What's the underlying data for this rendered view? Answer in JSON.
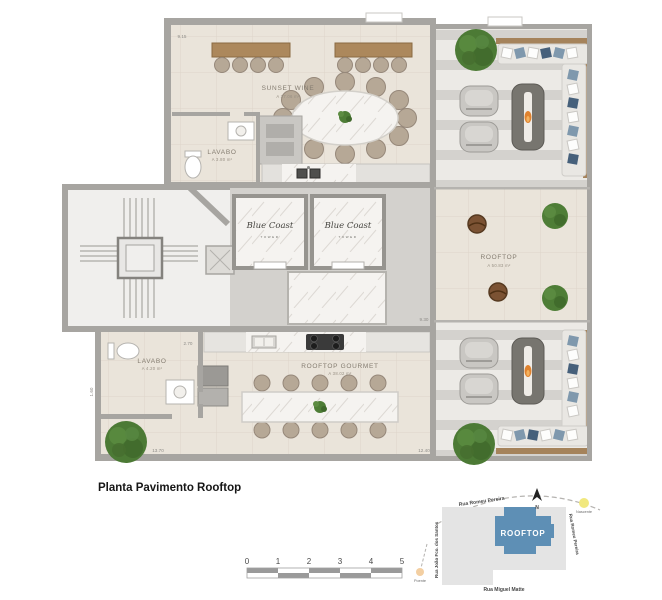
{
  "title": "Planta Pavimento Rooftop",
  "rooms": {
    "sunset_wine": {
      "name": "SUNSET WINE",
      "area": "A 37.06 m²"
    },
    "lavabo_upper": {
      "name": "LAVABO",
      "area": "A 3.80 m²"
    },
    "rooftop_open": {
      "name": "ROOFTOP",
      "area": "A 50.83 m²"
    },
    "rooftop_gourmet": {
      "name": "ROOFTOP GOURMET",
      "area": "A 38.02 m²"
    },
    "lavabo_lower": {
      "name": "LAVABO",
      "area": "A 4.20 m²"
    }
  },
  "elevators": {
    "brand": "Blue Coast",
    "sub_label": "TOWER"
  },
  "dimensions": {
    "top_width": "9.15",
    "core_height": "9.30",
    "lavabo_width": "2.70",
    "lavabo_height": "1.60",
    "bottom_left_width": "13.70",
    "bottom_right_width": "12.40"
  },
  "site_map": {
    "building_label": "ROOFTOP",
    "north_label": "N",
    "sun_east_label": "Nascente",
    "sun_west_label": "Poente",
    "street_top": "Rua Romeu Pereira",
    "street_right": "Rua Romeu Pereira",
    "street_left": "Rua João Fco. dos Santos",
    "street_bottom": "Rua Miguel Matte"
  },
  "scale_bar": {
    "ticks": [
      "0",
      "1",
      "2",
      "3",
      "4",
      "5"
    ]
  },
  "colors": {
    "floor_tile": "#eae4da",
    "deck_light": "#eceae6",
    "deck_stripe": "#d4d2ce",
    "wall": "#a7a5a1",
    "wood": "#ac885c",
    "marble": "#f5f3f0",
    "tree_green": "#4c7a35",
    "flame_orange": "#e0832f",
    "map_block_blue": "#5e8fb5"
  }
}
